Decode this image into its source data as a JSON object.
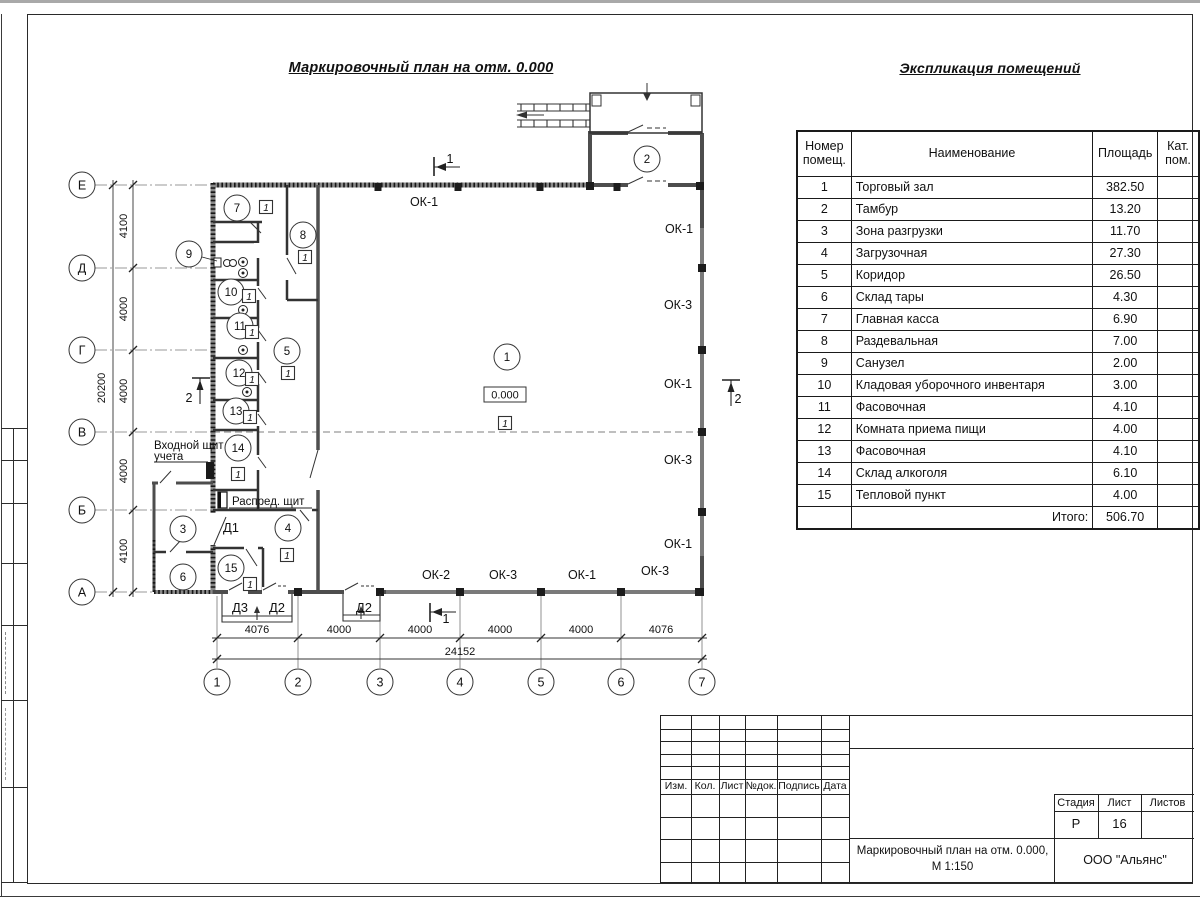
{
  "page": {
    "plan_title": "Маркировочный план на отм. 0.000",
    "table_title": "Экспликация помещений"
  },
  "exploration_table": {
    "col_headers": {
      "number": "Номер\nпомещ.",
      "name": "Наименование",
      "area": "Площадь",
      "category": "Кат.\nпом."
    },
    "rows": [
      {
        "number": "1",
        "name": "Торговый зал",
        "area": "382.50",
        "category": ""
      },
      {
        "number": "2",
        "name": "Тамбур",
        "area": "13.20",
        "category": ""
      },
      {
        "number": "3",
        "name": "Зона разгрузки",
        "area": "11.70",
        "category": ""
      },
      {
        "number": "4",
        "name": "Загрузочная",
        "area": "27.30",
        "category": ""
      },
      {
        "number": "5",
        "name": "Коридор",
        "area": "26.50",
        "category": ""
      },
      {
        "number": "6",
        "name": "Склад тары",
        "area": "4.30",
        "category": ""
      },
      {
        "number": "7",
        "name": "Главная касса",
        "area": "6.90",
        "category": ""
      },
      {
        "number": "8",
        "name": "Раздевальная",
        "area": "7.00",
        "category": ""
      },
      {
        "number": "9",
        "name": "Санузел",
        "area": "2.00",
        "category": ""
      },
      {
        "number": "10",
        "name": "Кладовая уборочного инвентаря",
        "area": "3.00",
        "category": ""
      },
      {
        "number": "11",
        "name": "Фасовочная",
        "area": "4.10",
        "category": ""
      },
      {
        "number": "12",
        "name": "Комната приема пищи",
        "area": "4.00",
        "category": ""
      },
      {
        "number": "13",
        "name": "Фасовочная",
        "area": "4.10",
        "category": ""
      },
      {
        "number": "14",
        "name": "Склад алкоголя",
        "area": "6.10",
        "category": ""
      },
      {
        "number": "15",
        "name": "Тепловой пункт",
        "area": "4.00",
        "category": ""
      }
    ],
    "total_label": "Итого:",
    "total_value": "506.70"
  },
  "plan": {
    "elevation_mark": "0.000",
    "floor_type_mark": "1",
    "axes_left": [
      {
        "label": "Е",
        "y": 185
      },
      {
        "label": "Д",
        "y": 268
      },
      {
        "label": "Г",
        "y": 350
      },
      {
        "label": "В",
        "y": 432
      },
      {
        "label": "Б",
        "y": 510
      },
      {
        "label": "А",
        "y": 592
      }
    ],
    "axes_bottom": [
      {
        "label": "1",
        "x": 217
      },
      {
        "label": "2",
        "x": 298
      },
      {
        "label": "3",
        "x": 380
      },
      {
        "label": "4",
        "x": 460
      },
      {
        "label": "5",
        "x": 541
      },
      {
        "label": "6",
        "x": 621
      },
      {
        "label": "7",
        "x": 702
      }
    ],
    "dims_left": [
      {
        "text": "4100",
        "y": 226
      },
      {
        "text": "4000",
        "y": 309
      },
      {
        "text": "4000",
        "y": 391
      },
      {
        "text": "4000",
        "y": 471
      },
      {
        "text": "4100",
        "y": 551
      }
    ],
    "dim_left_total": {
      "text": "20200",
      "x": 105,
      "y": 388
    },
    "dims_bottom": [
      {
        "text": "4076",
        "x": 257
      },
      {
        "text": "4000",
        "x": 339
      },
      {
        "text": "4000",
        "x": 420
      },
      {
        "text": "4000",
        "x": 500
      },
      {
        "text": "4000",
        "x": 581
      },
      {
        "text": "4076",
        "x": 661
      }
    ],
    "dim_bottom_total": {
      "text": "24152",
      "x": 460,
      "y": 655
    },
    "room_markers": [
      {
        "label": "1",
        "x": 507,
        "y": 357
      },
      {
        "label": "2",
        "x": 647,
        "y": 159
      },
      {
        "label": "3",
        "x": 183,
        "y": 529
      },
      {
        "label": "4",
        "x": 288,
        "y": 528
      },
      {
        "label": "5",
        "x": 287,
        "y": 351
      },
      {
        "label": "6",
        "x": 183,
        "y": 577
      },
      {
        "label": "7",
        "x": 237,
        "y": 208
      },
      {
        "label": "8",
        "x": 303,
        "y": 235
      },
      {
        "label": "9",
        "x": 189,
        "y": 254
      },
      {
        "label": "10",
        "x": 231,
        "y": 292
      },
      {
        "label": "11",
        "x": 240,
        "y": 326
      },
      {
        "label": "12",
        "x": 239,
        "y": 373
      },
      {
        "label": "13",
        "x": 236,
        "y": 411
      },
      {
        "label": "14",
        "x": 238,
        "y": 448
      },
      {
        "label": "15",
        "x": 231,
        "y": 568
      }
    ],
    "floor_marks": [
      {
        "x": 266,
        "y": 207
      },
      {
        "x": 305,
        "y": 257
      },
      {
        "x": 249,
        "y": 296
      },
      {
        "x": 252,
        "y": 332
      },
      {
        "x": 252,
        "y": 379
      },
      {
        "x": 250,
        "y": 417
      },
      {
        "x": 238,
        "y": 474
      },
      {
        "x": 288,
        "y": 373
      },
      {
        "x": 505,
        "y": 423
      },
      {
        "x": 287,
        "y": 555
      },
      {
        "x": 250,
        "y": 584
      }
    ],
    "window_labels": [
      {
        "text": "ОК-1",
        "x": 424,
        "y": 206
      },
      {
        "text": "ОК-1",
        "x": 679,
        "y": 233
      },
      {
        "text": "ОК-3",
        "x": 678,
        "y": 309
      },
      {
        "text": "ОК-1",
        "x": 678,
        "y": 388
      },
      {
        "text": "ОК-3",
        "x": 678,
        "y": 464
      },
      {
        "text": "ОК-1",
        "x": 678,
        "y": 548
      },
      {
        "text": "ОК-2",
        "x": 436,
        "y": 579
      },
      {
        "text": "ОК-3",
        "x": 503,
        "y": 579
      },
      {
        "text": "ОК-1",
        "x": 582,
        "y": 579
      },
      {
        "text": "ОК-3",
        "x": 655,
        "y": 575
      }
    ],
    "door_labels": [
      {
        "text": "Д1",
        "x": 231,
        "y": 532
      },
      {
        "text": "Д3",
        "x": 240,
        "y": 612
      },
      {
        "text": "Д2",
        "x": 277,
        "y": 612
      },
      {
        "text": "Д2",
        "x": 364,
        "y": 612
      }
    ],
    "section_labels": [
      {
        "text": "1",
        "x": 450,
        "y": 163
      },
      {
        "text": "1",
        "x": 446,
        "y": 623
      },
      {
        "text": "2",
        "x": 189,
        "y": 402
      },
      {
        "text": "2",
        "x": 738,
        "y": 403
      }
    ],
    "annotations": {
      "entry_panel_line1": "Входной щит",
      "entry_panel_line2": "учета",
      "dist_panel": "Распред. щит"
    }
  },
  "title_block": {
    "header_cols": [
      "Изм.",
      "Кол.",
      "Лист",
      "№док.",
      "Подпись",
      "Дата"
    ],
    "stage_label": "Стадия",
    "sheet_label": "Лист",
    "sheets_label": "Листов",
    "stage_value": "Р",
    "sheet_value": "16",
    "sheets_value": "",
    "doc_title_line1": "Маркировочный план на отм. 0.000,",
    "doc_title_line2": "М 1:150",
    "company": "ООО \"Альянс\""
  }
}
